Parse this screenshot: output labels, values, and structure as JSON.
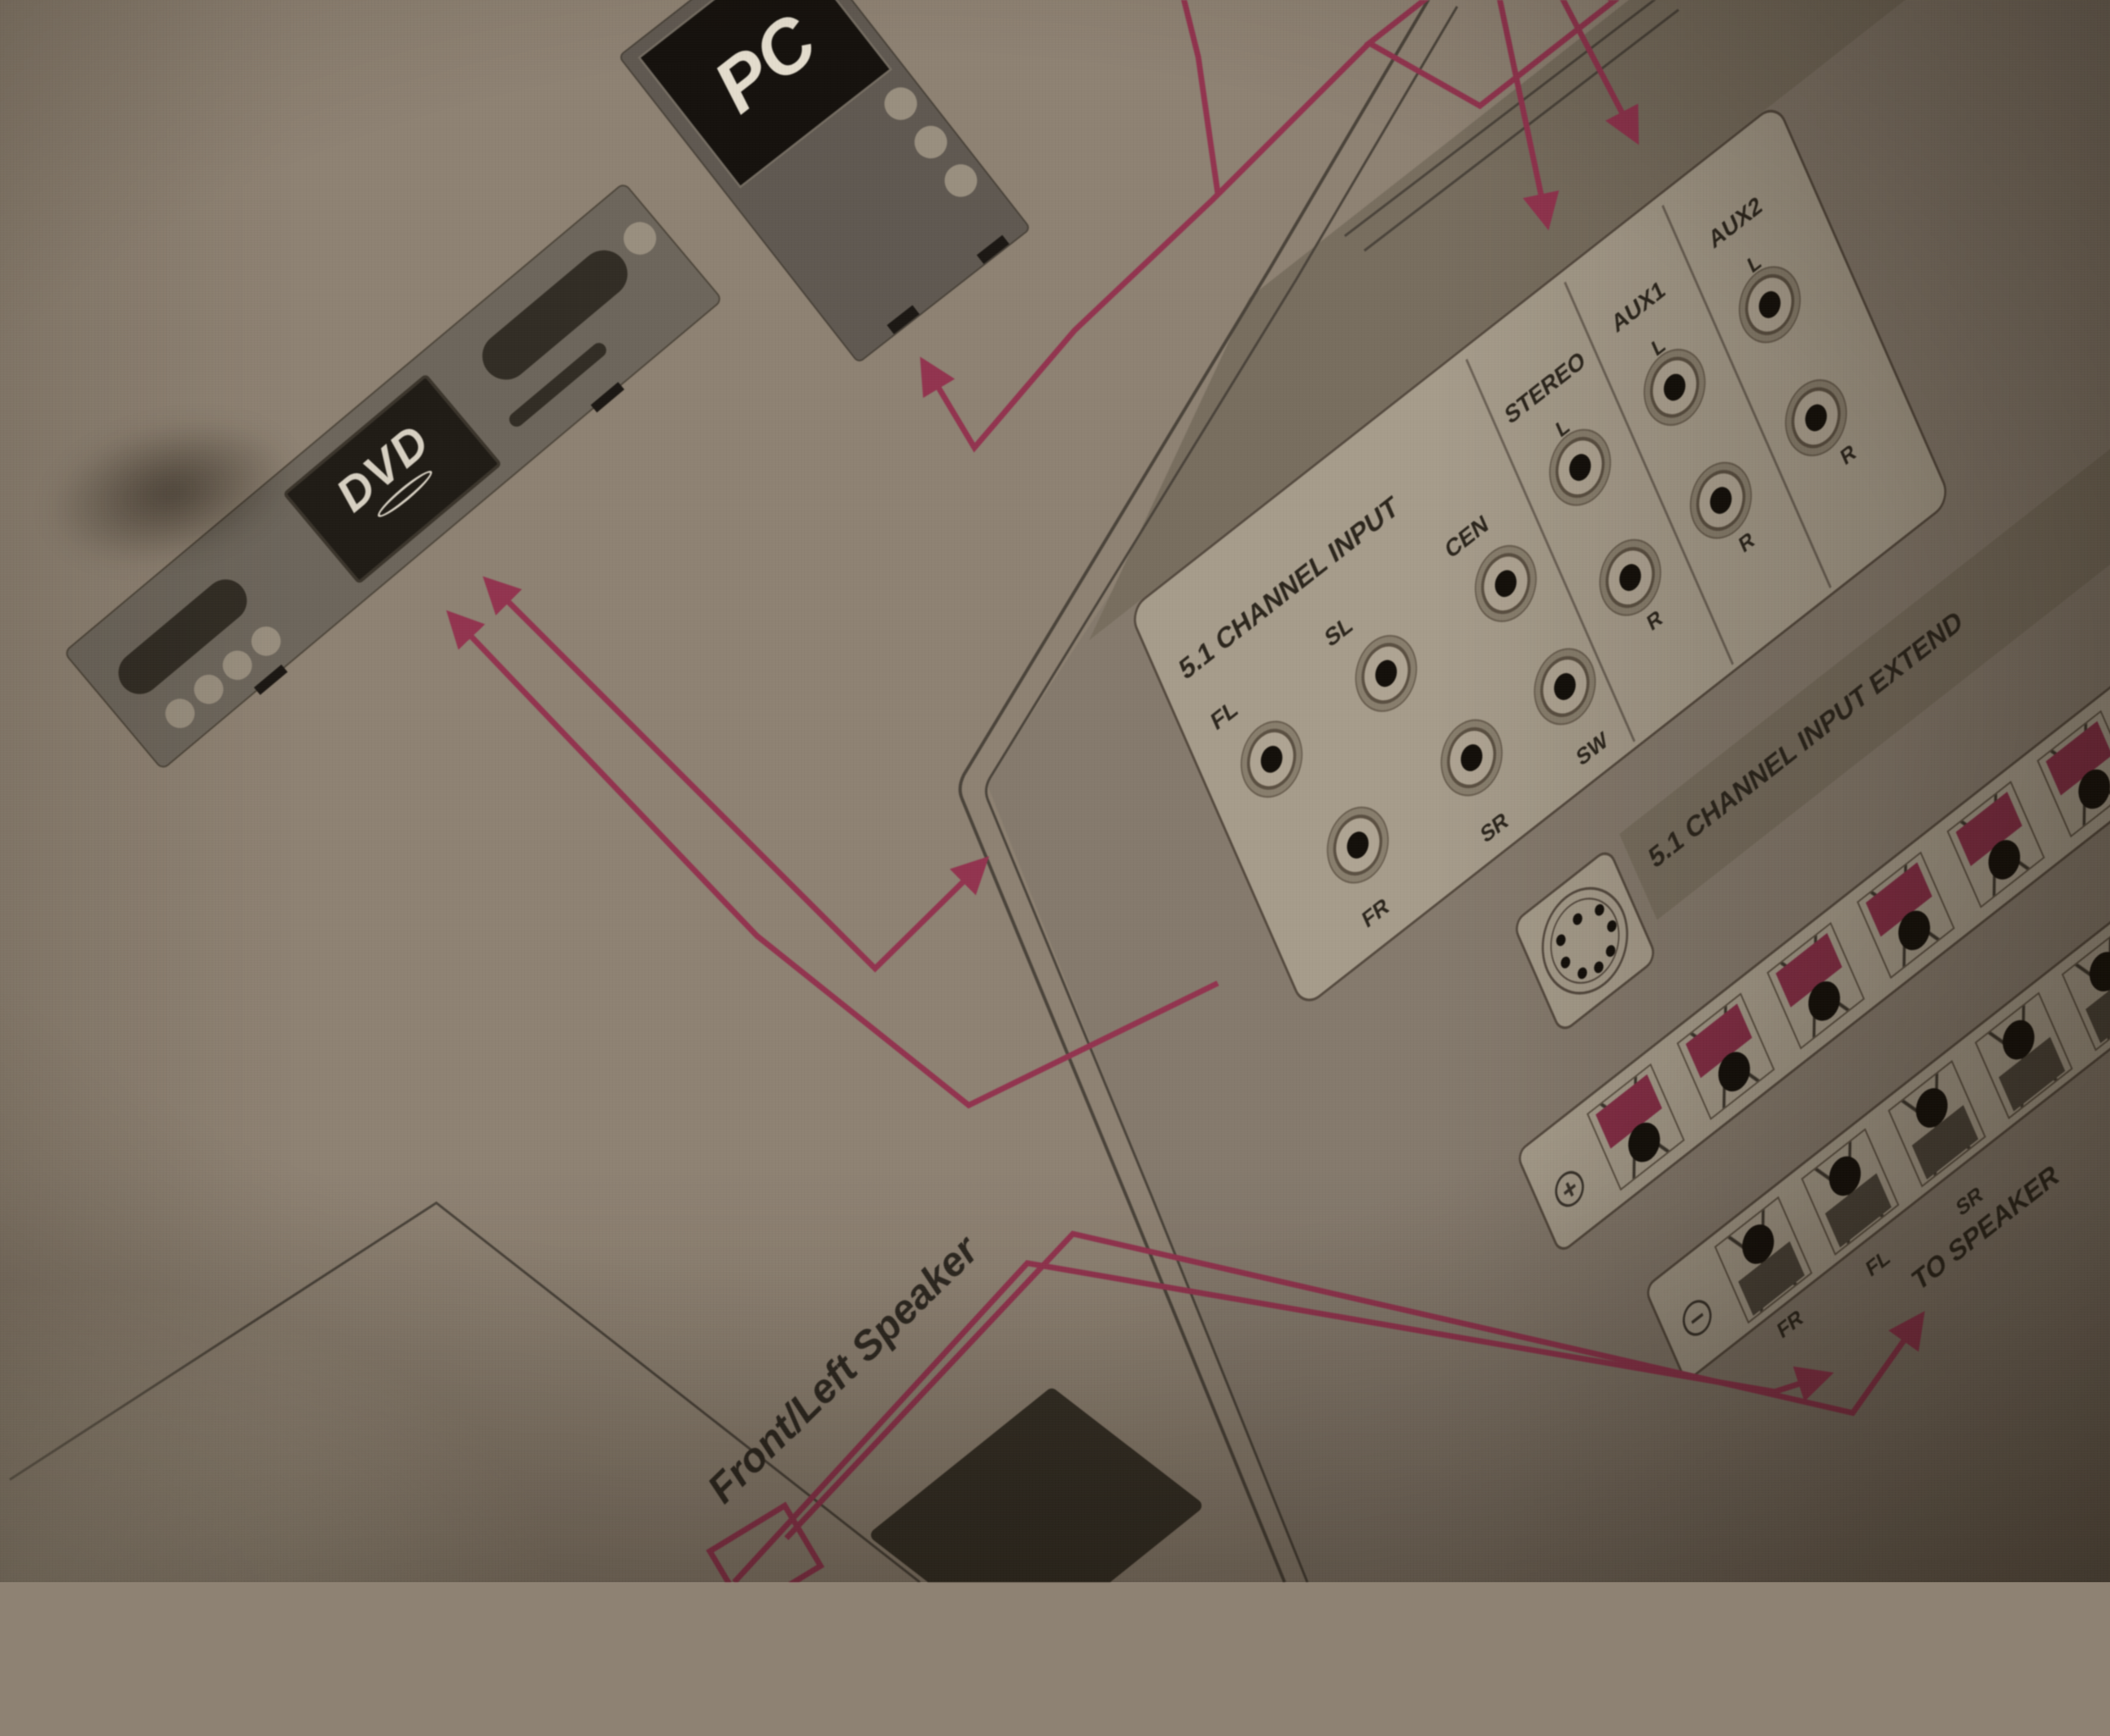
{
  "devices": {
    "dvd": "DVD",
    "pc": "PC"
  },
  "jack_panel": {
    "group_51": {
      "title": "5.1 CHANNEL INPUT",
      "top_row": [
        "FL",
        "SL",
        "CEN"
      ],
      "bottom_row": [
        "FR",
        "SR",
        "SW"
      ]
    },
    "columns": [
      {
        "label": "STEREO",
        "top": "L",
        "bottom": "R"
      },
      {
        "label": "AUX1",
        "top": "L",
        "bottom": "R"
      },
      {
        "label": "AUX2",
        "top": "L",
        "bottom": "R"
      }
    ],
    "extend": "5.1 CHANNEL INPUT EXTEND"
  },
  "terminals": {
    "plus": "+",
    "minus": "−",
    "labels": [
      "FR",
      "FL",
      "SR"
    ],
    "to_speaker": "TO SPEAKER"
  },
  "speaker": {
    "front_left": "Front/Left Speaker"
  },
  "colors": {
    "paper": "#8e8273",
    "panel_tan": "#796e5d",
    "panel_white": "#a79c89",
    "ink": "#2d261c",
    "wire_red": "#9c3150",
    "terminal_red": "#8d2b47"
  }
}
